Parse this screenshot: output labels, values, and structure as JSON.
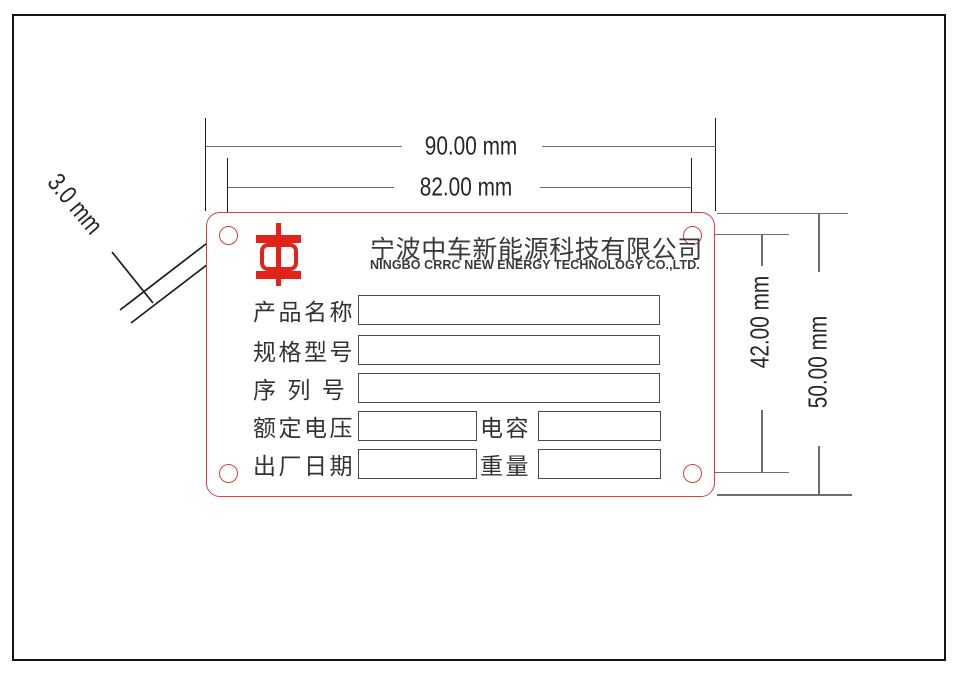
{
  "colors": {
    "brand_red": "#E2231A",
    "plate_red": "#D8413C",
    "line_gray": "#6E6E6E",
    "line_dark": "#1D1D1D",
    "text_dark": "#3A3A3A",
    "dim_text": "#262626",
    "box_border": "#4A4A4A"
  },
  "plate": {
    "company_cn": "宁波中车新能源科技有限公司",
    "company_en": "NINGBO CRRC NEW ENERGY TECHNOLOGY CO.,LTD.",
    "rows": [
      {
        "label": "产品名称"
      },
      {
        "label": "规格型号"
      },
      {
        "label": "序 列 号"
      },
      {
        "label": "额定电压",
        "label2": "电容"
      },
      {
        "label": "出厂日期",
        "label2": "重量"
      }
    ]
  },
  "dimensions": {
    "total_width": "90.00 mm",
    "hole_spacing_horizontal": "82.00 mm",
    "hole_spacing_vertical": "42.00 mm",
    "total_height": "50.00 mm",
    "hole_diameter": "3.0 mm"
  }
}
